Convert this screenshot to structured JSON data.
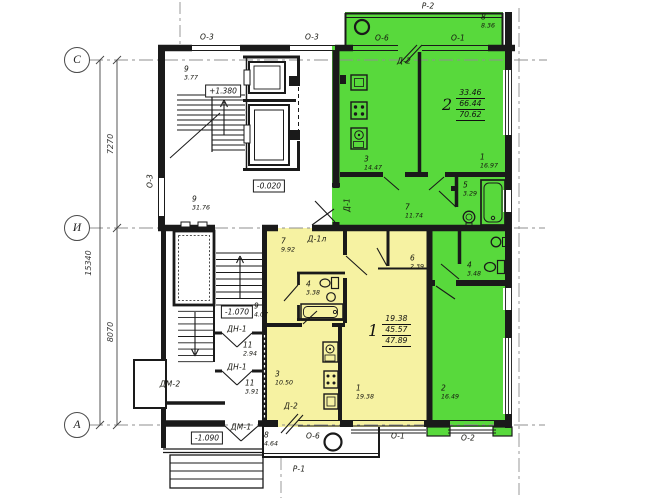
{
  "drawing": {
    "colors": {
      "apartment_2_fill": "#58d93c",
      "apartment_1_fill": "#f6f2a2"
    },
    "axes": {
      "row_labels": [
        "С",
        "И",
        "А"
      ],
      "dim_span_top": "7270",
      "dim_span_bottom": "8070",
      "dim_overall": "15340"
    },
    "elevations": {
      "stair_landing": "+1.380",
      "ground_floor": "-0.020",
      "lower_landing": "-1.070",
      "entrance": "-1.090"
    },
    "window_marks": {
      "top_left": "О-3",
      "top_mid": "О-3",
      "left_wall": "О-3",
      "balcony_top": "Р-2",
      "green_kitchen_window": "О-6",
      "green_room_window": "О-1",
      "yellow_kitchen_window": "О-6",
      "yellow_room_window": "О-1",
      "green_lower_window": "О-2",
      "balcony_bottom": "Р-1"
    },
    "door_marks": {
      "green_balcony_door": "Д-2",
      "green_entry_door": "Д-1",
      "yellow_entry_door": "Д-1л",
      "yellow_balcony_door": "Д-2",
      "vestibule_door_1": "ДН-1",
      "vestibule_door_2": "ДН-1",
      "side_entrance_door": "ДМ-2",
      "main_entrance_door": "ДМ-1"
    },
    "apartment_2": {
      "number": "2",
      "area_living": "33.46",
      "area_usable": "66.44",
      "area_total": "70.62",
      "rooms": {
        "balcony": {
          "n": "8",
          "area": "8.36"
        },
        "kitchen": {
          "n": "3",
          "area": "14.47"
        },
        "living": {
          "n": "1",
          "area": "16.97"
        },
        "hall": {
          "n": "7",
          "area": "11.74"
        },
        "bath": {
          "n": "5",
          "area": "3.29"
        },
        "wc": {
          "n": "4",
          "area": "3.48"
        },
        "bedroom": {
          "n": "2",
          "area": "16.49"
        }
      }
    },
    "apartment_1": {
      "number": "1",
      "area_living": "19.38",
      "area_usable": "45.57",
      "area_total": "47.89",
      "rooms": {
        "hall": {
          "n": "7",
          "area": "9.92"
        },
        "bath": {
          "n": "4",
          "area": "3.38"
        },
        "closet": {
          "n": "6",
          "area": "2.39"
        },
        "living": {
          "n": "1",
          "area": "19.38"
        },
        "kitchen": {
          "n": "3",
          "area": "10.50"
        },
        "balcony": {
          "n": "8",
          "area": "4.64"
        }
      }
    },
    "common": {
      "stair_upper": {
        "n": "9",
        "area": "3.77"
      },
      "corridor": {
        "n": "9",
        "area": "31.76"
      },
      "stair_lower": {
        "n": "9",
        "area": "4.07"
      },
      "lobby_1": {
        "n": "11",
        "area": "2.94"
      },
      "lobby_2": {
        "n": "11",
        "area": "3.91"
      }
    }
  }
}
